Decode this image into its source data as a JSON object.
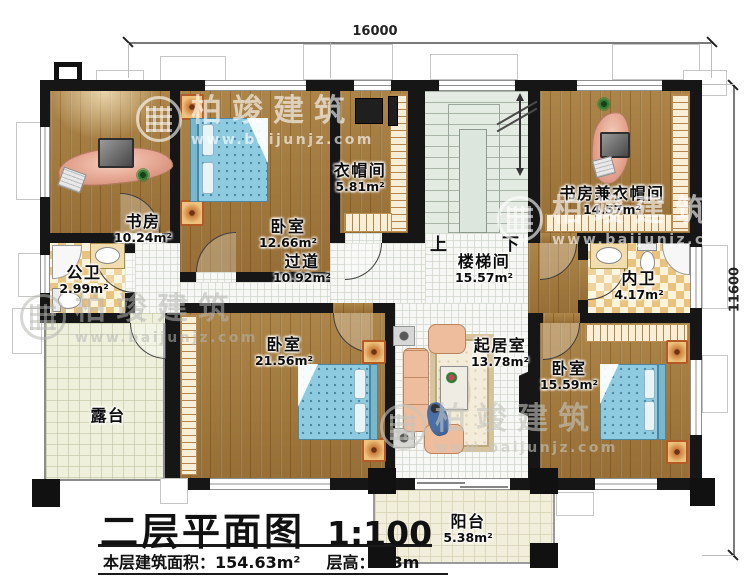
{
  "plan": {
    "title": "二层平面图",
    "scale": "1:100",
    "area_text": "本层建筑面积：154.63m²",
    "height_text": "层高：3.3m"
  },
  "dimensions": {
    "top": "16000",
    "right": "11600"
  },
  "stairs": {
    "up_label": "上",
    "down_label": "下"
  },
  "watermark": {
    "brand": "柏竣建筑",
    "url": "www.baijunjz.com"
  },
  "rooms": [
    {
      "id": "study",
      "name": "书房",
      "area": "10.24m²"
    },
    {
      "id": "bedroom-top",
      "name": "卧室",
      "area": "12.66m²"
    },
    {
      "id": "cloakroom",
      "name": "衣帽间",
      "area": "5.81m²"
    },
    {
      "id": "study-cloakroom",
      "name": "书房兼衣帽间",
      "area": "14.57m²"
    },
    {
      "id": "public-bath",
      "name": "公卫",
      "area": "2.99m²"
    },
    {
      "id": "corridor",
      "name": "过道",
      "area": "10.92m²"
    },
    {
      "id": "stairwell",
      "name": "楼梯间",
      "area": "15.57m²"
    },
    {
      "id": "private-bath",
      "name": "内卫",
      "area": "4.17m²"
    },
    {
      "id": "bedroom-left",
      "name": "卧室",
      "area": "21.56m²"
    },
    {
      "id": "living-room",
      "name": "起居室",
      "area": "13.78m²"
    },
    {
      "id": "bedroom-right",
      "name": "卧室",
      "area": "15.59m²"
    },
    {
      "id": "terrace",
      "name": "露台",
      "area": ""
    },
    {
      "id": "balcony",
      "name": "阳台",
      "area": "5.38m²"
    }
  ],
  "palette": {
    "wall": "#161616",
    "wood_floor": "#a37b3f",
    "bed_blue": "#8fcbe0",
    "bath_tile": "#eac47f",
    "stair_green": "#e4ebe2",
    "terrace_tile": "#eef0dc"
  }
}
